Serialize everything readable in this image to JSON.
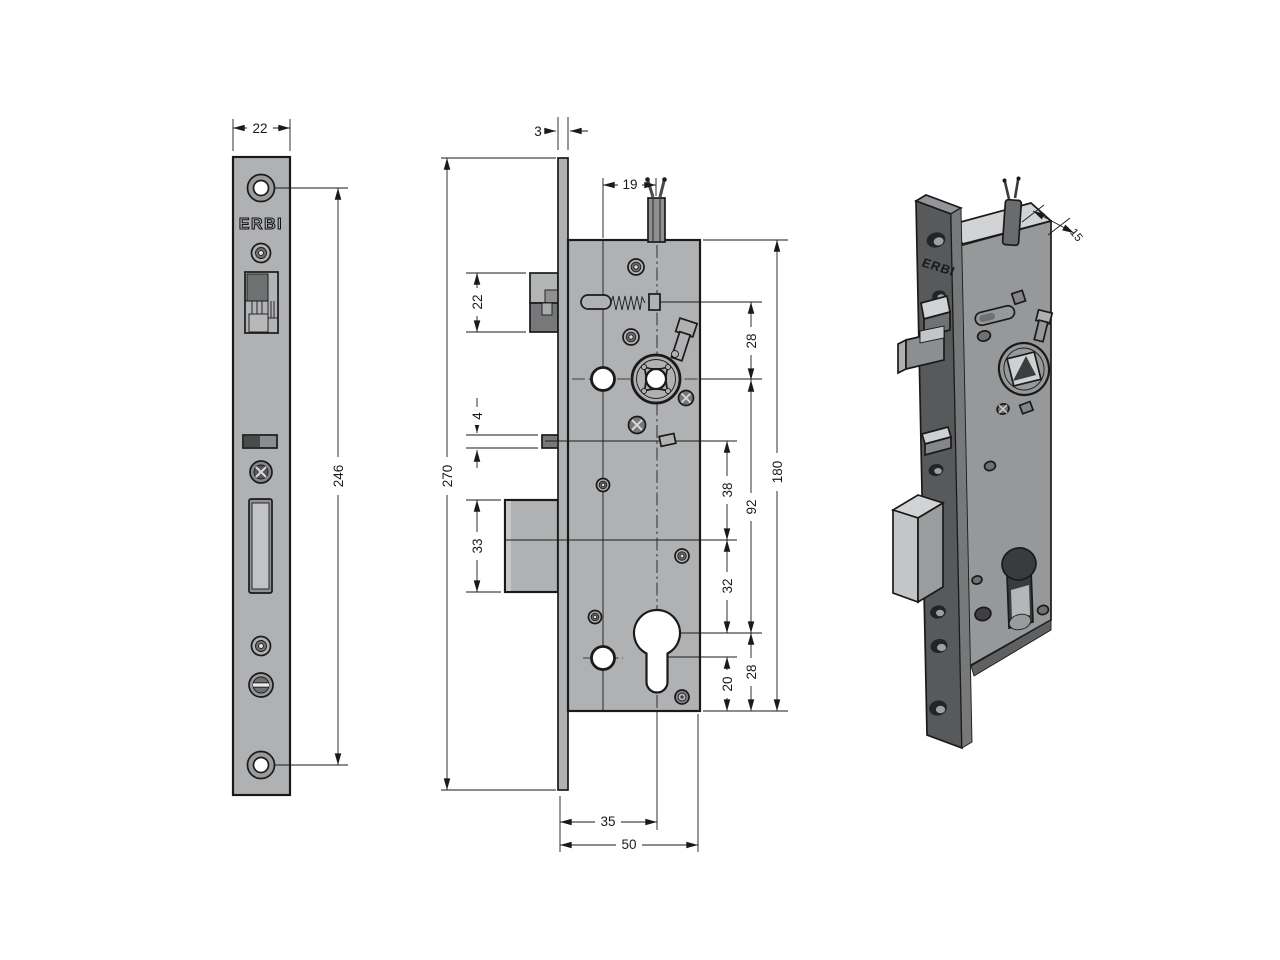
{
  "brand": "ERBI",
  "dimensions": {
    "faceplate_width": "22",
    "hole_spacing": "246",
    "faceplate_thickness": "3",
    "cable_offset": "19",
    "latch_height": "22",
    "aux_bolt_height": "4",
    "deadbolt_height": "33",
    "faceplate_height": "270",
    "latch_to_spindle": "28",
    "spindle_to_cylinder": "92",
    "aux_to_deadbolt": "38",
    "deadbolt_to_cylinder": "32",
    "cylinder_to_edge": "28",
    "stem_to_edge": "20",
    "case_height": "180",
    "backset": "35",
    "case_depth": "50",
    "case_thickness": "15"
  }
}
